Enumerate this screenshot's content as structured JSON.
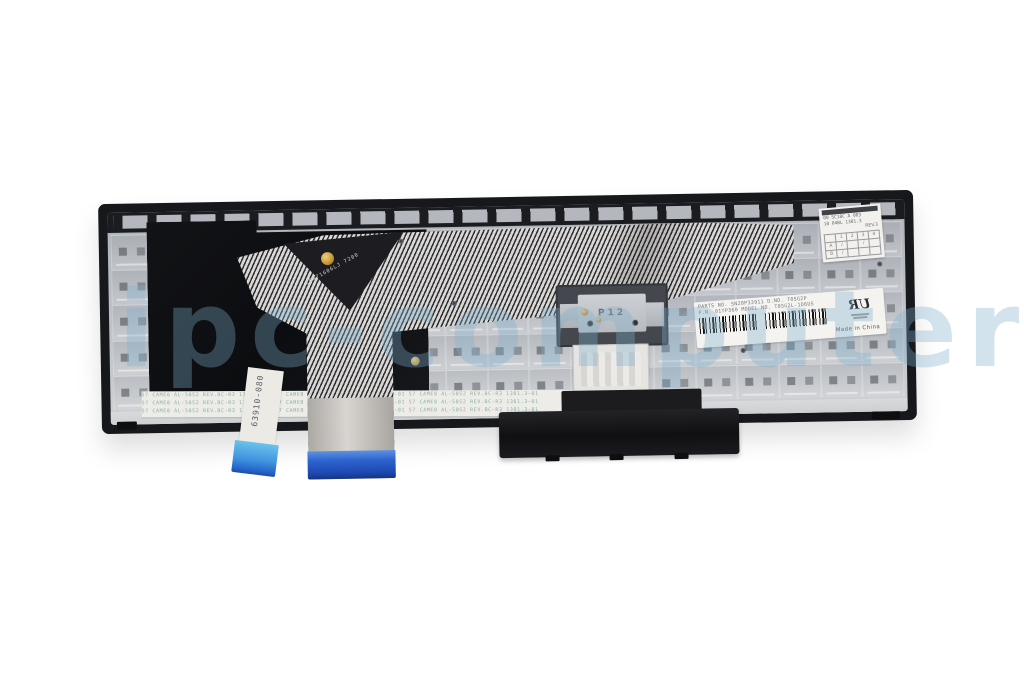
{
  "watermark": {
    "text": "ipc-computer",
    "color": "#7fb0cf"
  },
  "cable": {
    "marking": "LDW71606LJ 7200",
    "ribbon_code": "63910-080"
  },
  "bracket": {
    "code": "P12"
  },
  "mylar": {
    "repeat_text": "57 CAME0 AL-5052 REV.BC-R3 1301.3-01   ",
    "rows": 3,
    "repeats_per_row": 3,
    "ink_color": "#7fae90"
  },
  "main_label": {
    "line1": "PARTS NO. SN20P33911   D.NO. T05G2P",
    "line2": "P.N. 01YP360   MODEL NO. T05G2L-1D6US",
    "made_in": "Made in China",
    "ul_text": "UR"
  },
  "qc_label": {
    "line1": "00 5C18C A 003",
    "line2": "10 04BL 1301.3",
    "rev": "REV.3",
    "grid": {
      "headers": [
        "",
        "1",
        "2",
        "3",
        "4"
      ],
      "rows": [
        [
          "A",
          "/",
          "",
          "/",
          ""
        ],
        [
          "B",
          "/",
          "",
          "",
          ""
        ]
      ]
    }
  },
  "grid_texture": {
    "columns": 19,
    "rows": 5
  }
}
